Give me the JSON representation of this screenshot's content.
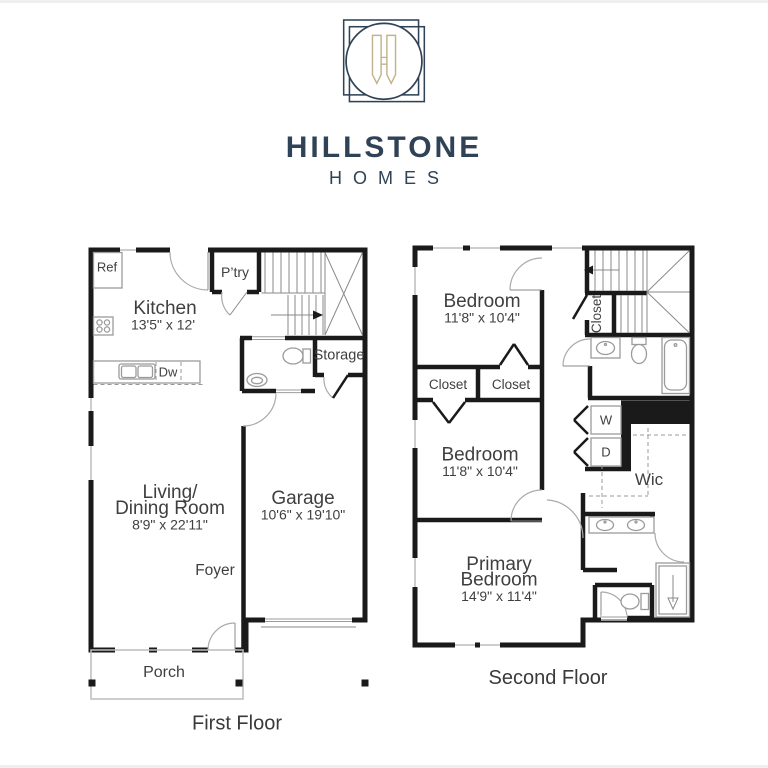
{
  "brand": {
    "name": "HILLSTONE",
    "tagline": "HOMES",
    "monogram": "H"
  },
  "palette": {
    "navy": "#2f4256",
    "gold": "#c2b38c",
    "room_fill": "#e9e9e9",
    "wall": "#1a1a1a",
    "fixture_line": "#9b9b9b",
    "label_text": "#3f3f3f"
  },
  "first_floor": {
    "caption": "First Floor",
    "rooms": {
      "ref": "Ref",
      "kitchen_name": "Kitchen",
      "kitchen_dims": "13'5\" x 12'",
      "pantry": "P’try",
      "dishwasher": "Dw",
      "storage": "Storage",
      "living_line1": "Living/",
      "living_line2": "Dining Room",
      "living_dims": "8'9\" x 22'11\"",
      "garage_name": "Garage",
      "garage_dims": "10'6\" x 19'10\"",
      "foyer": "Foyer",
      "porch": "Porch"
    }
  },
  "second_floor": {
    "caption": "Second Floor",
    "rooms": {
      "bedroom1_name": "Bedroom",
      "bedroom1_dims": "11'8\" x 10'4\"",
      "closet_left": "Closet",
      "closet_right": "Closet",
      "closet_stairs": "Closet",
      "bedroom2_name": "Bedroom",
      "bedroom2_dims": "11'8\" x 10'4\"",
      "washer": "W",
      "dryer": "D",
      "wic": "Wic",
      "primary_line1": "Primary",
      "primary_line2": "Bedroom",
      "primary_dims": "14'9\" x 11'4\""
    }
  }
}
